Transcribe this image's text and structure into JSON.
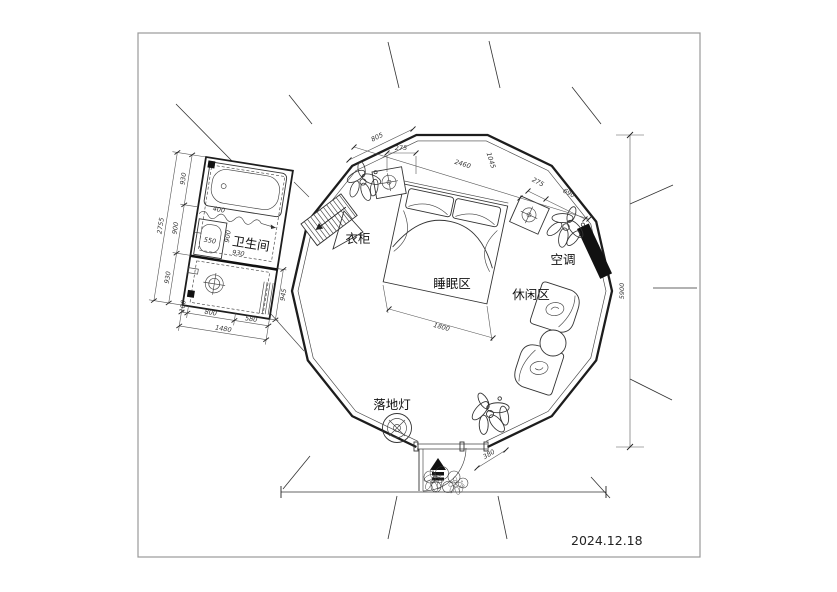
{
  "meta": {
    "date": "2024.12.18"
  },
  "labels": {
    "bathroom": "卫生间",
    "wardrobe": "衣柜",
    "sleeping_area": "睡眠区",
    "leisure_area": "休闲区",
    "air_conditioner": "空调",
    "floor_lamp": "落地灯"
  },
  "dimensions": {
    "overall_height": "5900",
    "top_edge": "805",
    "top_nightstand": "275",
    "bed_span": "2460",
    "bed_offset": "1045",
    "right_nightstand": "275",
    "right_wall": "690",
    "bed_width": "1800",
    "entry_width": "380",
    "bath_height_total": "2755",
    "bath_h_top": "930",
    "bath_h_mid": "900",
    "bath_h_bot": "930",
    "bath_width_total": "1480",
    "bath_w_left": "100",
    "bath_w_mid": "800",
    "bath_w_right": "580",
    "bath_right_edge": "945",
    "bath_sink": "550",
    "bath_inner_h": "900",
    "bath_inner_w": "930",
    "bath_tub": "400"
  },
  "icons": {
    "lamp_symbol": "circle-cross",
    "floor_drain_symbol": "circle-cross",
    "entry_arrow": "filled-triangle-up",
    "plant": "leaf-cluster",
    "stair_arrow": "left-arrow"
  },
  "colors": {
    "line": "#222222",
    "ac_fill": "#111111",
    "frame_border": "#999999"
  }
}
